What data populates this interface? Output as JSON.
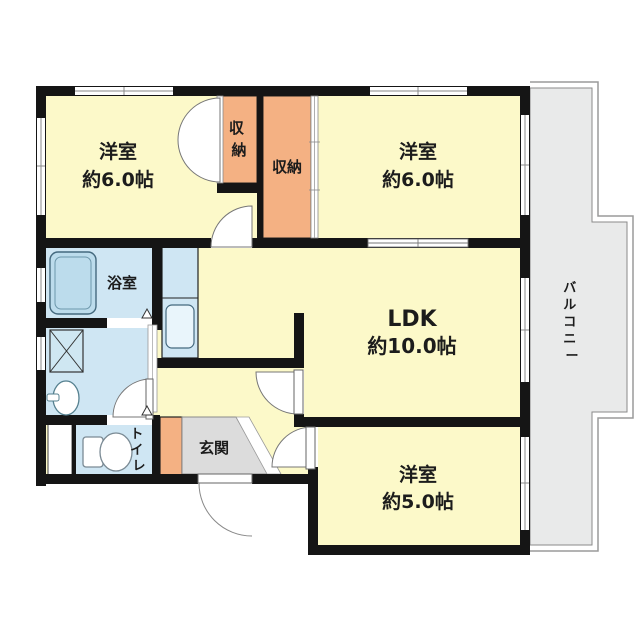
{
  "floorplan": {
    "rooms": {
      "bedroom1": {
        "name": "洋室",
        "size": "約6.0帖"
      },
      "bedroom2": {
        "name": "洋室",
        "size": "約6.0帖"
      },
      "bedroom3": {
        "name": "洋室",
        "size": "約5.0帖"
      },
      "ldk": {
        "name": "LDK",
        "size": "約10.0帖"
      },
      "bathroom": {
        "name": "浴室"
      },
      "entrance": {
        "name": "玄関"
      },
      "closet1": {
        "name": "収納",
        "chars": [
          "収",
          "納"
        ]
      },
      "closet2": {
        "name": "収納"
      },
      "toilet": {
        "name": "トイレ",
        "chars": [
          "ト",
          "イ",
          "レ"
        ]
      },
      "balcony": {
        "name": "バルコニー",
        "chars": [
          "バ",
          "ル",
          "コ",
          "ニ",
          "ー"
        ]
      }
    },
    "colors": {
      "room_cream": "#fcf9c9",
      "closet_orange": "#f4b183",
      "wet_area_blue": "#cfe6f3",
      "entrance_gray": "#dcdcdc",
      "balcony_gray": "#e9eaea",
      "wall_black": "#151515",
      "background": "#ffffff"
    }
  }
}
